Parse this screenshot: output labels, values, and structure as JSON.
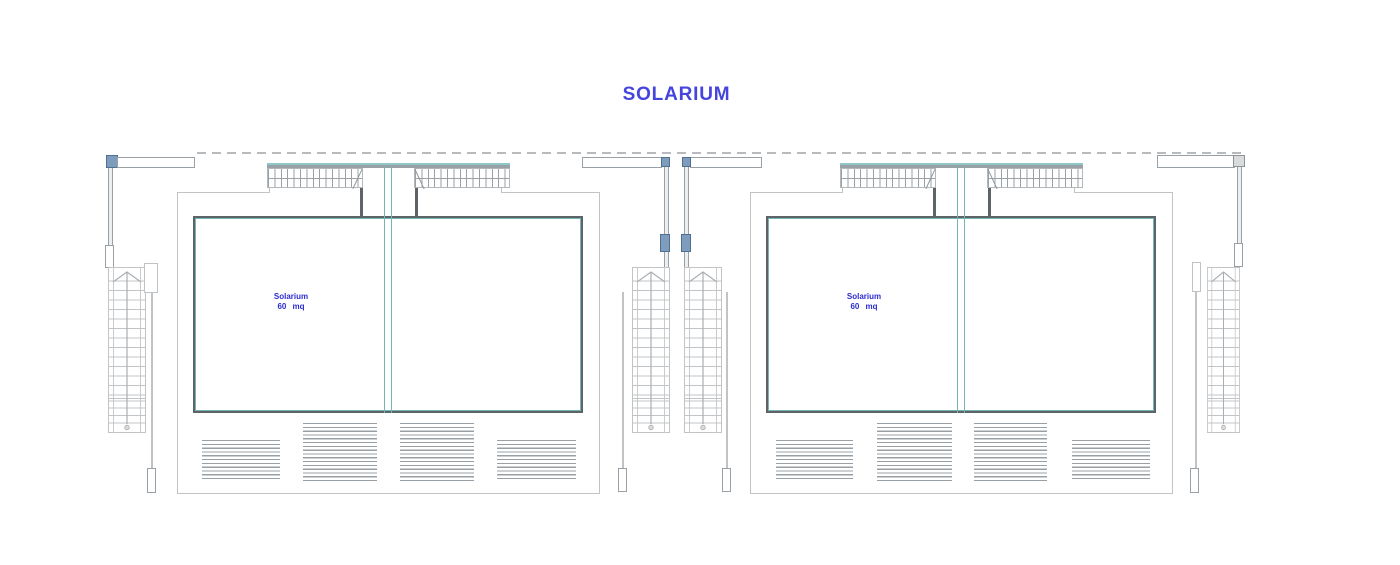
{
  "drawing": {
    "title": "SOLARIUM",
    "units": [
      {
        "room_label": "Solarium",
        "area_label": "60 mq"
      },
      {
        "room_label": "Solarium",
        "area_label": "60 mq"
      }
    ],
    "colors": {
      "title_text": "#4545de",
      "room_label_text": "#2b2bd2",
      "wall_dark": "#5d6367",
      "line_light": "#c0c4c7",
      "line_medium": "#9aa1a6",
      "glass_teal": "#74b5b5",
      "column_blue_fill": "#7d9cbe",
      "column_gray_fill": "#d9dbdc"
    }
  }
}
